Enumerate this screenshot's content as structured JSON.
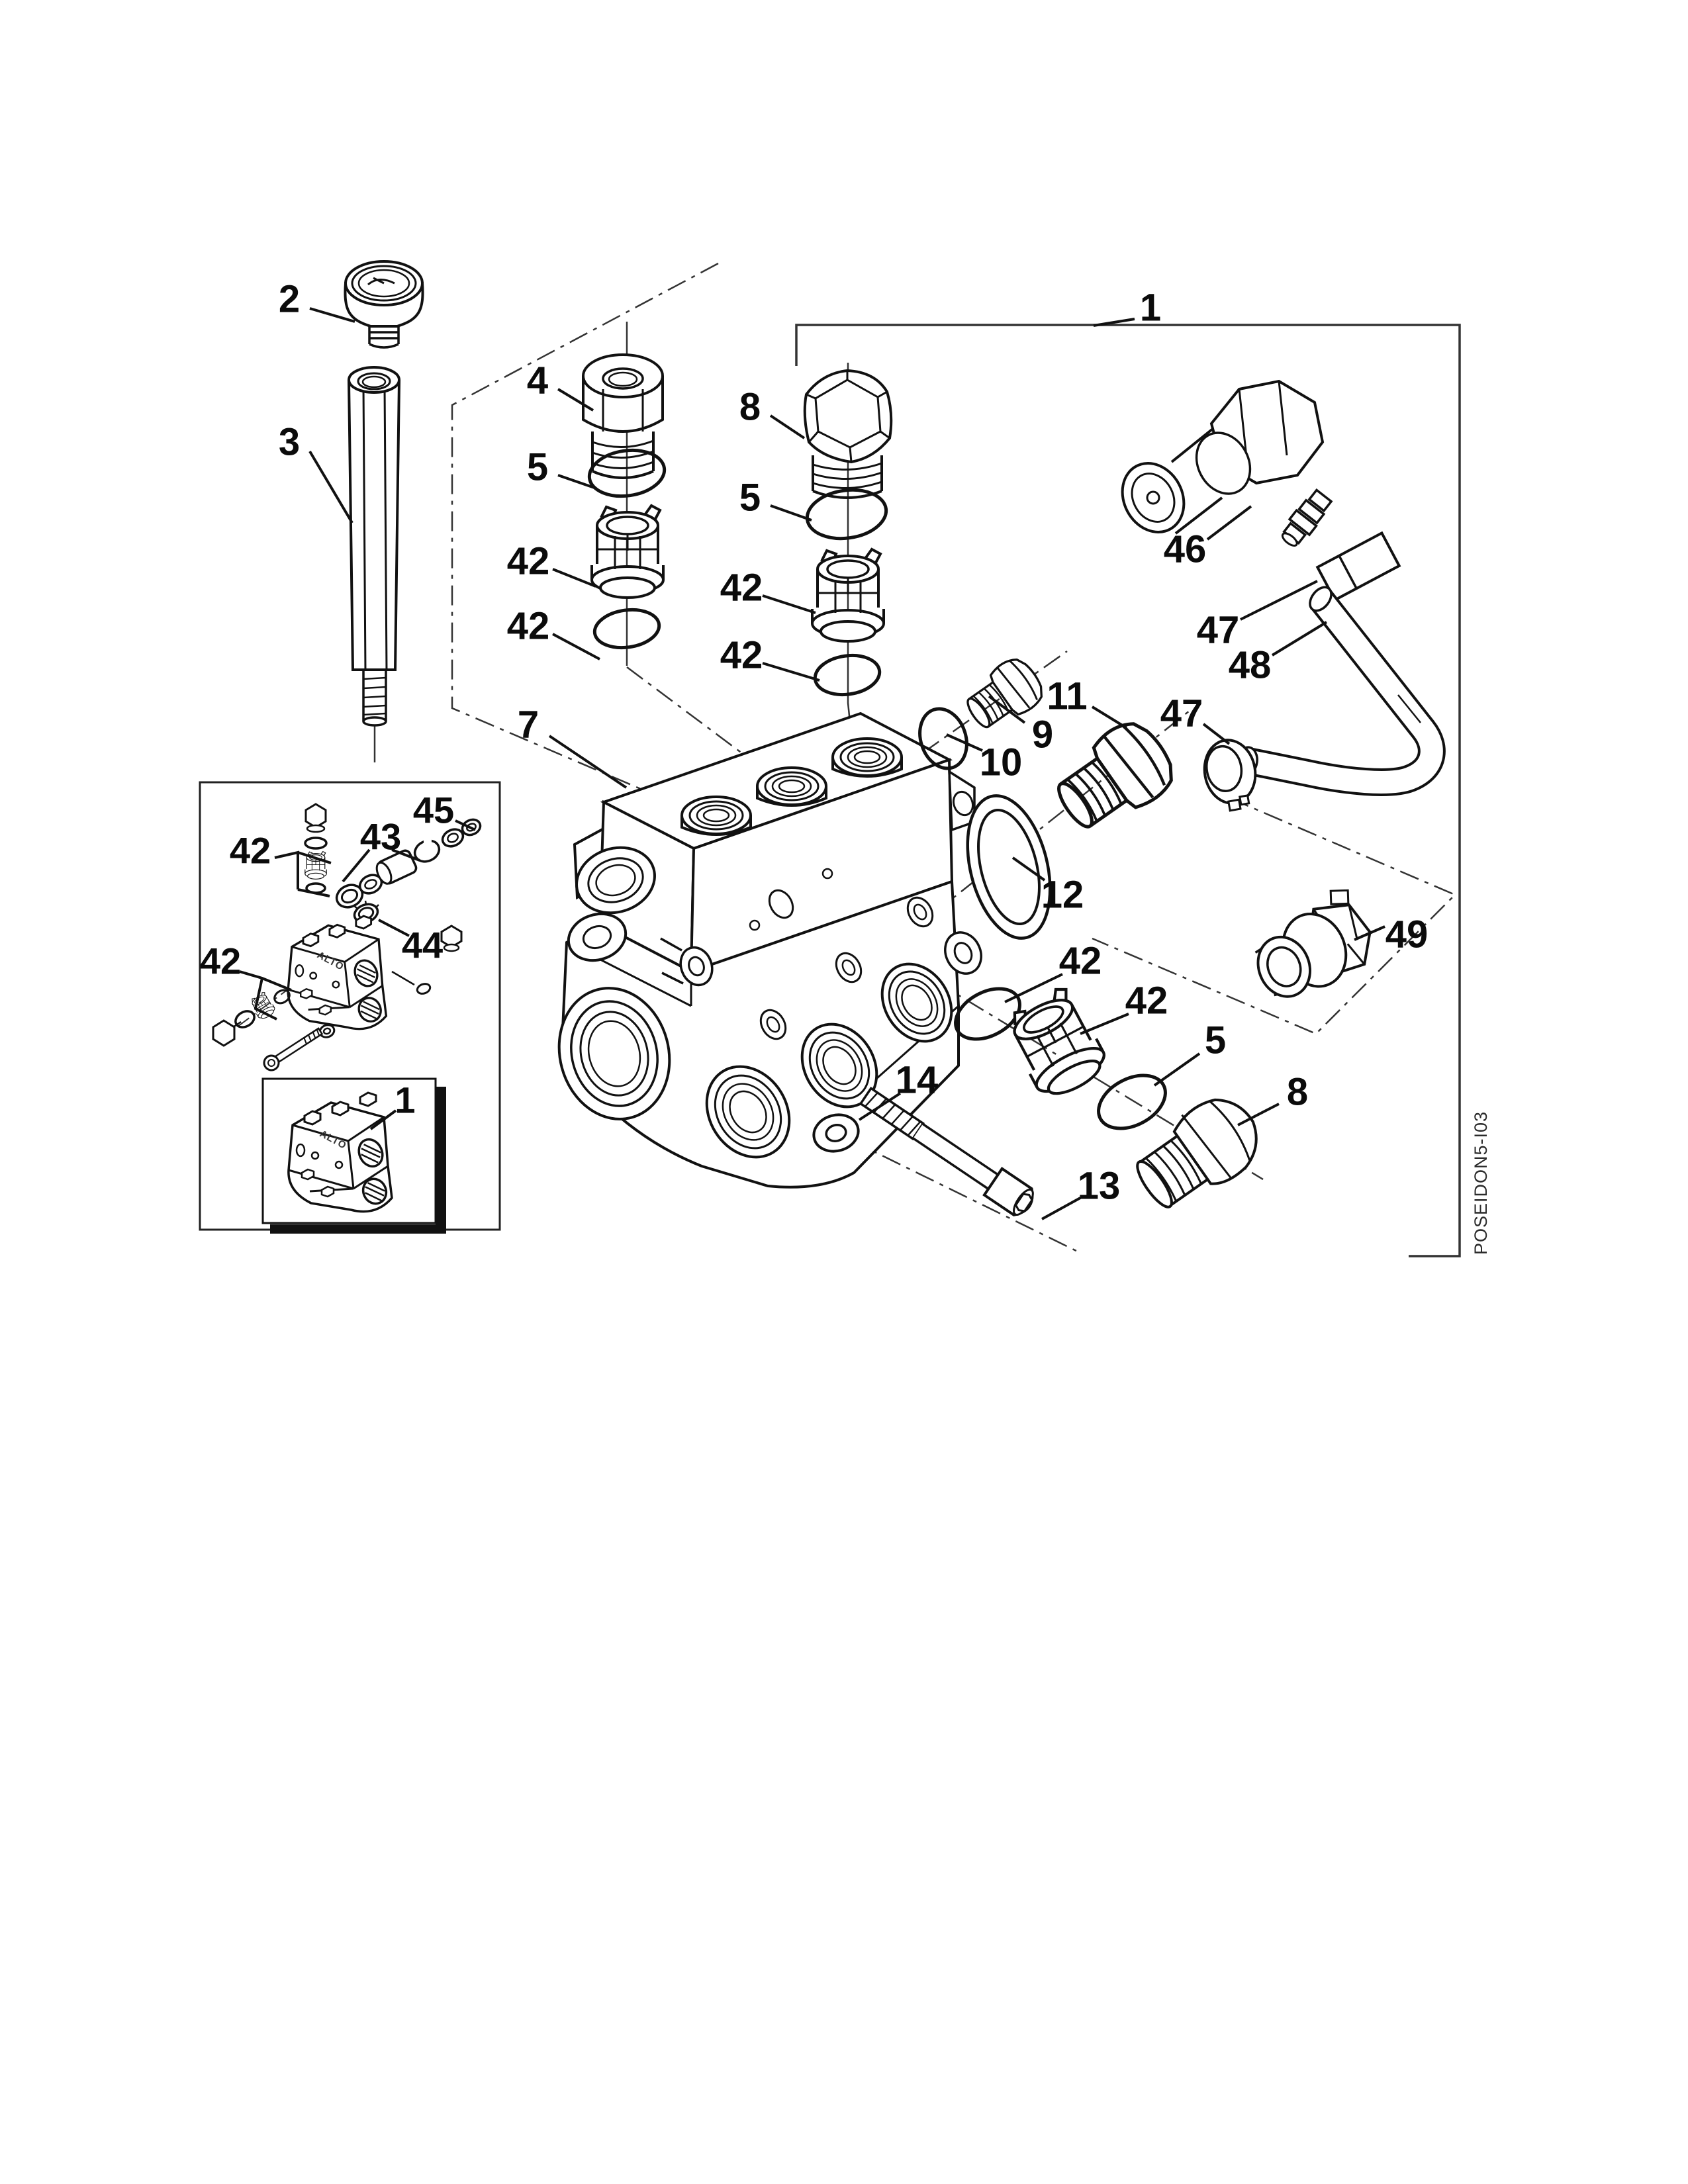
{
  "figure": {
    "drawing_code": "POSEIDON5-I03",
    "pump_logo": "ALTO",
    "callouts": [
      {
        "label": "2"
      },
      {
        "label": "3"
      },
      {
        "label": "4"
      },
      {
        "label": "5"
      },
      {
        "label": "42"
      },
      {
        "label": "42"
      },
      {
        "label": "8"
      },
      {
        "label": "5"
      },
      {
        "label": "42"
      },
      {
        "label": "42"
      },
      {
        "label": "1"
      },
      {
        "label": "46"
      },
      {
        "label": "47"
      },
      {
        "label": "48"
      },
      {
        "label": "9"
      },
      {
        "label": "10"
      },
      {
        "label": "11"
      },
      {
        "label": "47"
      },
      {
        "label": "12"
      },
      {
        "label": "49"
      },
      {
        "label": "7"
      },
      {
        "label": "42"
      },
      {
        "label": "42"
      },
      {
        "label": "5"
      },
      {
        "label": "8"
      },
      {
        "label": "14"
      },
      {
        "label": "13"
      },
      {
        "label": "45"
      },
      {
        "label": "43"
      },
      {
        "label": "42"
      },
      {
        "label": "44"
      },
      {
        "label": "42"
      },
      {
        "label": "1"
      }
    ]
  }
}
